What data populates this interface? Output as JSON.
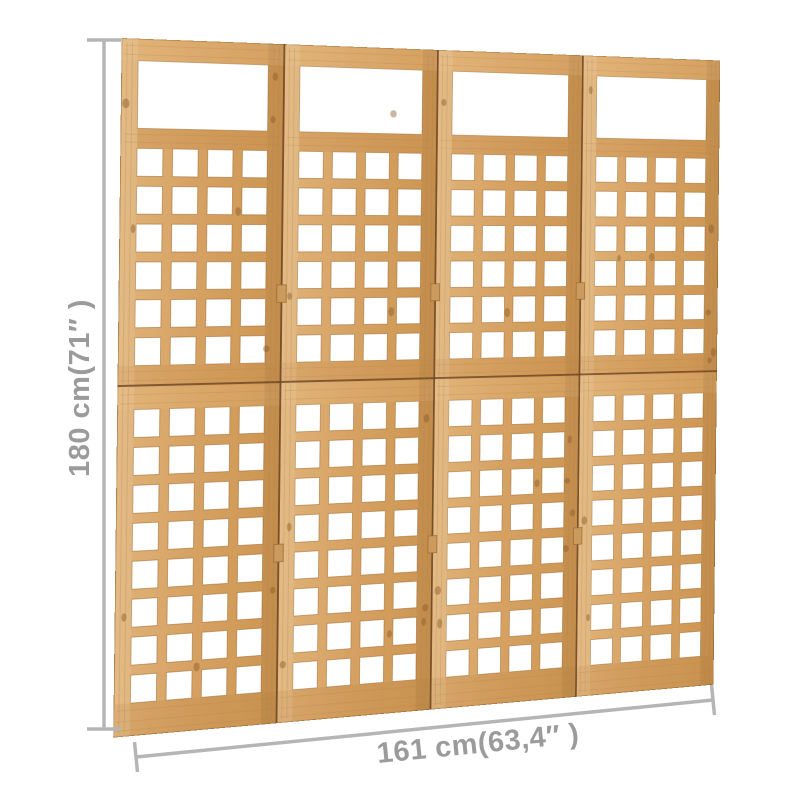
{
  "canvas": {
    "background": "#ffffff",
    "width": 800,
    "height": 800
  },
  "dimensions": {
    "height_label": "180 cm(71″ )",
    "width_label": "161 cm(63,4″ )",
    "line_color": "#b5b5b5",
    "text_color": "#9b9b9b"
  },
  "trellis": {
    "panels": 4,
    "columns_per_panel": 4,
    "upper_rows": 6,
    "lower_rows": 8,
    "colors": {
      "wood_base": "#d6a263",
      "wood_light": "#e7bd83",
      "wood_shadow": "#b5813f",
      "wood_edge": "#9a6a33",
      "wood_dark_line": "#6b4423",
      "hinge": "#cb9b5e",
      "knot": "#8a5a2a",
      "opening": "#ffffff"
    }
  }
}
